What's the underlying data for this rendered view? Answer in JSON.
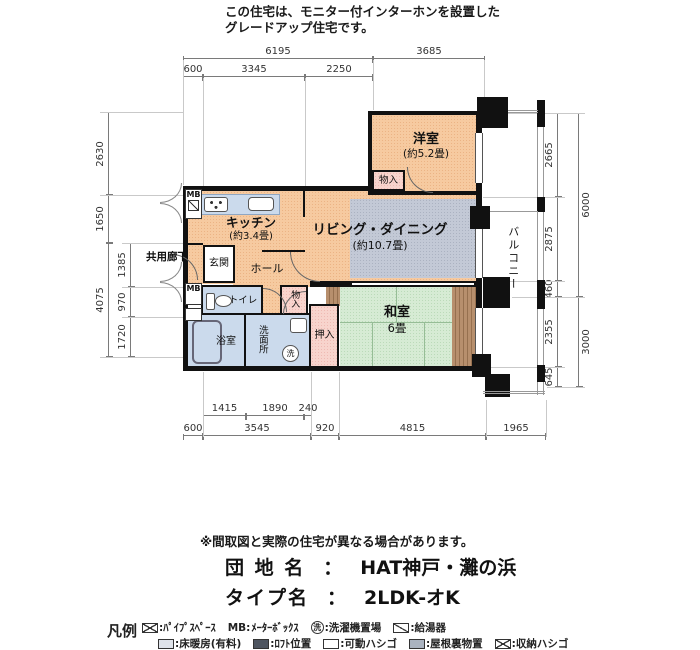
{
  "header": {
    "line1": "この住宅は、モニター付インターホンを設置した",
    "line2": "グレードアップ住宅です。"
  },
  "rooms": {
    "yoshitsu": {
      "name": "洋室",
      "size": "(約5.2畳)"
    },
    "living": {
      "name": "リビング・ダイニング",
      "size": "(約10.7畳)"
    },
    "kitchen": {
      "name": "キッチン",
      "size": "(約3.4畳)"
    },
    "washitsu": {
      "name": "和室",
      "size": "6畳"
    },
    "bath": "浴室",
    "washroom": "洗面所",
    "toilet": "トイレ",
    "hall": "ホール",
    "entrance": "玄関",
    "oshiire": "押入",
    "monoire": "物入",
    "balcony": "バルコニー",
    "corridor": "共用廊下",
    "mb": "MB",
    "laundry": "洗"
  },
  "dimensions": {
    "top_row1": [
      "6195",
      "3685"
    ],
    "top_row2": [
      "600",
      "3345",
      "2250"
    ],
    "left_outer": [
      "2630",
      "1650",
      "4075"
    ],
    "left_inner": [
      "1385",
      "970",
      "1720"
    ],
    "right_inner": [
      "2665",
      "2875",
      "460",
      "2355",
      "645"
    ],
    "right_outer": [
      "6000",
      "3000"
    ],
    "bottom_row1": [
      "1415",
      "1890",
      "240"
    ],
    "bottom_row2": [
      "600",
      "3545",
      "920",
      "4815",
      "1965"
    ]
  },
  "footer": {
    "note": "※間取図と実際の住宅が異なる場合があります。",
    "danchi_label": "団 地 名",
    "danchi_sep": "：",
    "danchi_value": "HAT神戸・灘の浜",
    "type_label": "タイプ名",
    "type_sep": "：",
    "type_value": "2LDK-オK"
  },
  "legend": {
    "title": "凡例",
    "row1": [
      {
        "label": ":ﾊﾟｲﾌﾟｽﾍﾟｰｽ"
      },
      {
        "prefix": "MB:",
        "label": "ﾒｰﾀｰﾎﾞｯｸｽ"
      },
      {
        "glyph": "洗",
        "label": ":洗濯機置場"
      },
      {
        "label": ":給湯器"
      }
    ],
    "row2": [
      {
        "label": ":床暖房(有料)"
      },
      {
        "label": ":ﾛﾌﾄ位置"
      },
      {
        "label": ":可動ハシゴ"
      },
      {
        "label": ":屋根裏物置"
      },
      {
        "label": ":収納ハシゴ"
      }
    ]
  },
  "colors": {
    "wall": "#111111",
    "room_peach": "#f6caa0",
    "room_pink": "#f8d4cd",
    "room_blue": "#cbdaec",
    "room_green": "#d6ebd4",
    "carpet_gray": "#c3c9d6",
    "wood_brown": "#b78f6d"
  }
}
